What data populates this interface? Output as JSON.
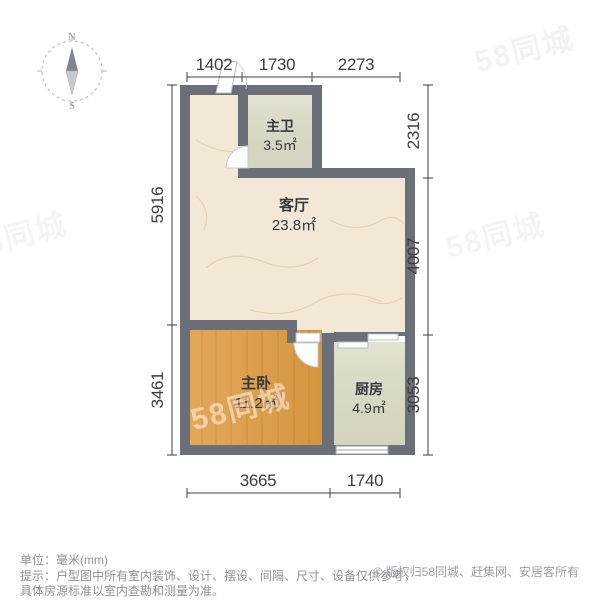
{
  "colors": {
    "wall": "#6b6f78",
    "living_floor": "#f3e8d5",
    "marble_vein": "#e2cda4",
    "tile_floor": "#dbdcc6",
    "wood_floor": "#e09d45",
    "wood_grain": "#c07f27",
    "dim_text": "#3c3c3c",
    "footer_text": "#8d9196"
  },
  "compass": {
    "north": "N",
    "south": "S"
  },
  "plan": {
    "rooms": [
      {
        "id": "master-bath",
        "name": "主卫",
        "area": "3.5㎡"
      },
      {
        "id": "living-room",
        "name": "客厅",
        "area": "23.8㎡"
      },
      {
        "id": "master-bedroom",
        "name": "主卧",
        "area": "11.2㎡"
      },
      {
        "id": "kitchen",
        "name": "厨房",
        "area": "4.9㎡"
      }
    ]
  },
  "dimensions": {
    "top": [
      "1402",
      "1730",
      "2273"
    ],
    "right": [
      "2316",
      "4007",
      "3053"
    ],
    "left": [
      "5916",
      "3461"
    ],
    "bottom": [
      "3665",
      "1740"
    ]
  },
  "footer": {
    "unit_line": "单位：毫米(mm)",
    "tip_line1": "提示：户型图中所有室内装饰、设计、摆设、间隔、尺寸、设备仅供参考，",
    "tip_line2": "具体房源标准以室内查勘和测量为准。",
    "copyright": "© 版权归58同城、赶集网、安居客所有"
  },
  "watermark": {
    "text": "58同城"
  }
}
